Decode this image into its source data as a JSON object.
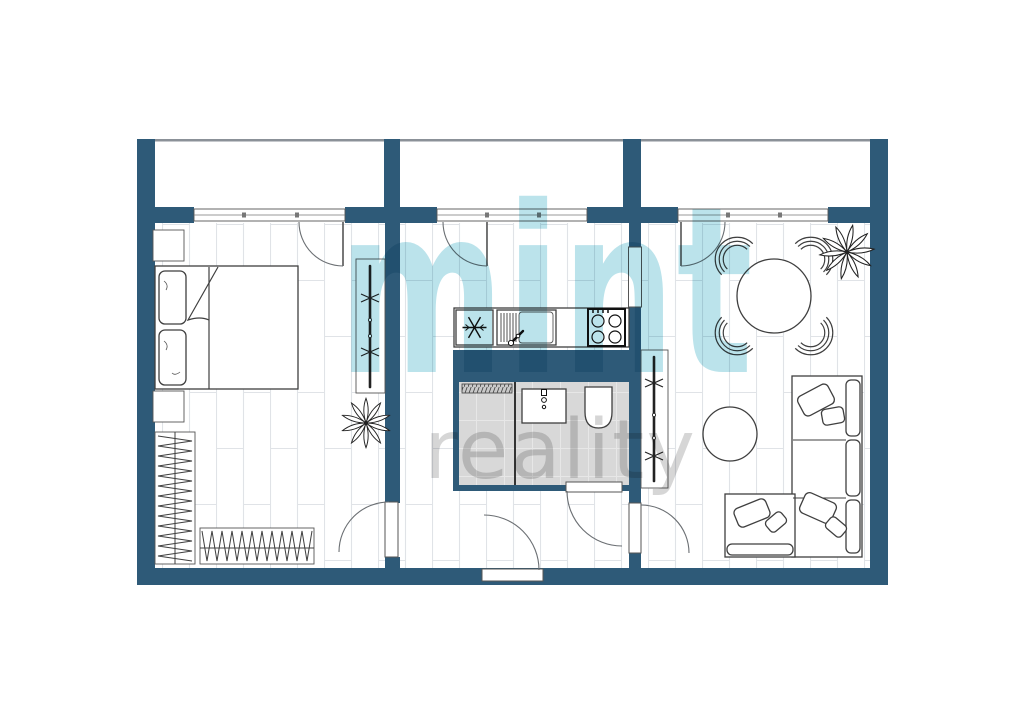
{
  "watermark": {
    "brand": "mint",
    "suffix": "reality"
  },
  "colors": {
    "wall": "#2e5a78",
    "watermark_mint": "#b5e1e9",
    "watermark_gray": "#cfcfcf",
    "line": "#3f3f3f",
    "floor_line": "#e0e3e7",
    "bathroom_floor": "#d8d8d8",
    "balcony_rail": "#8b9198"
  },
  "floor_plan": {
    "type": "apartment",
    "balconies": 3,
    "rooms": [
      {
        "name": "bedroom",
        "furniture": [
          "double-bed",
          "pillows",
          "nightstand",
          "nightstand",
          "wardrobe-rail",
          "plant",
          "open-closet-left",
          "open-closet-bottom",
          "balcony-door",
          "hall-door"
        ]
      },
      {
        "name": "kitchen",
        "furniture": [
          "fridge",
          "sink-with-drainboard",
          "stove-4-burners",
          "counter",
          "balcony-door",
          "pass-through-opening"
        ]
      },
      {
        "name": "bathroom",
        "furniture": [
          "storage-or-washer",
          "washbasin",
          "toilet",
          "door"
        ]
      },
      {
        "name": "hallway",
        "furniture": [
          "entrance-door"
        ]
      },
      {
        "name": "living-room",
        "furniture": [
          "round-dining-table",
          "chair",
          "chair",
          "chair",
          "chair",
          "plant",
          "coat-rack",
          "coffee-table",
          "corner-sofa",
          "balcony-door",
          "hall-door"
        ]
      }
    ]
  }
}
